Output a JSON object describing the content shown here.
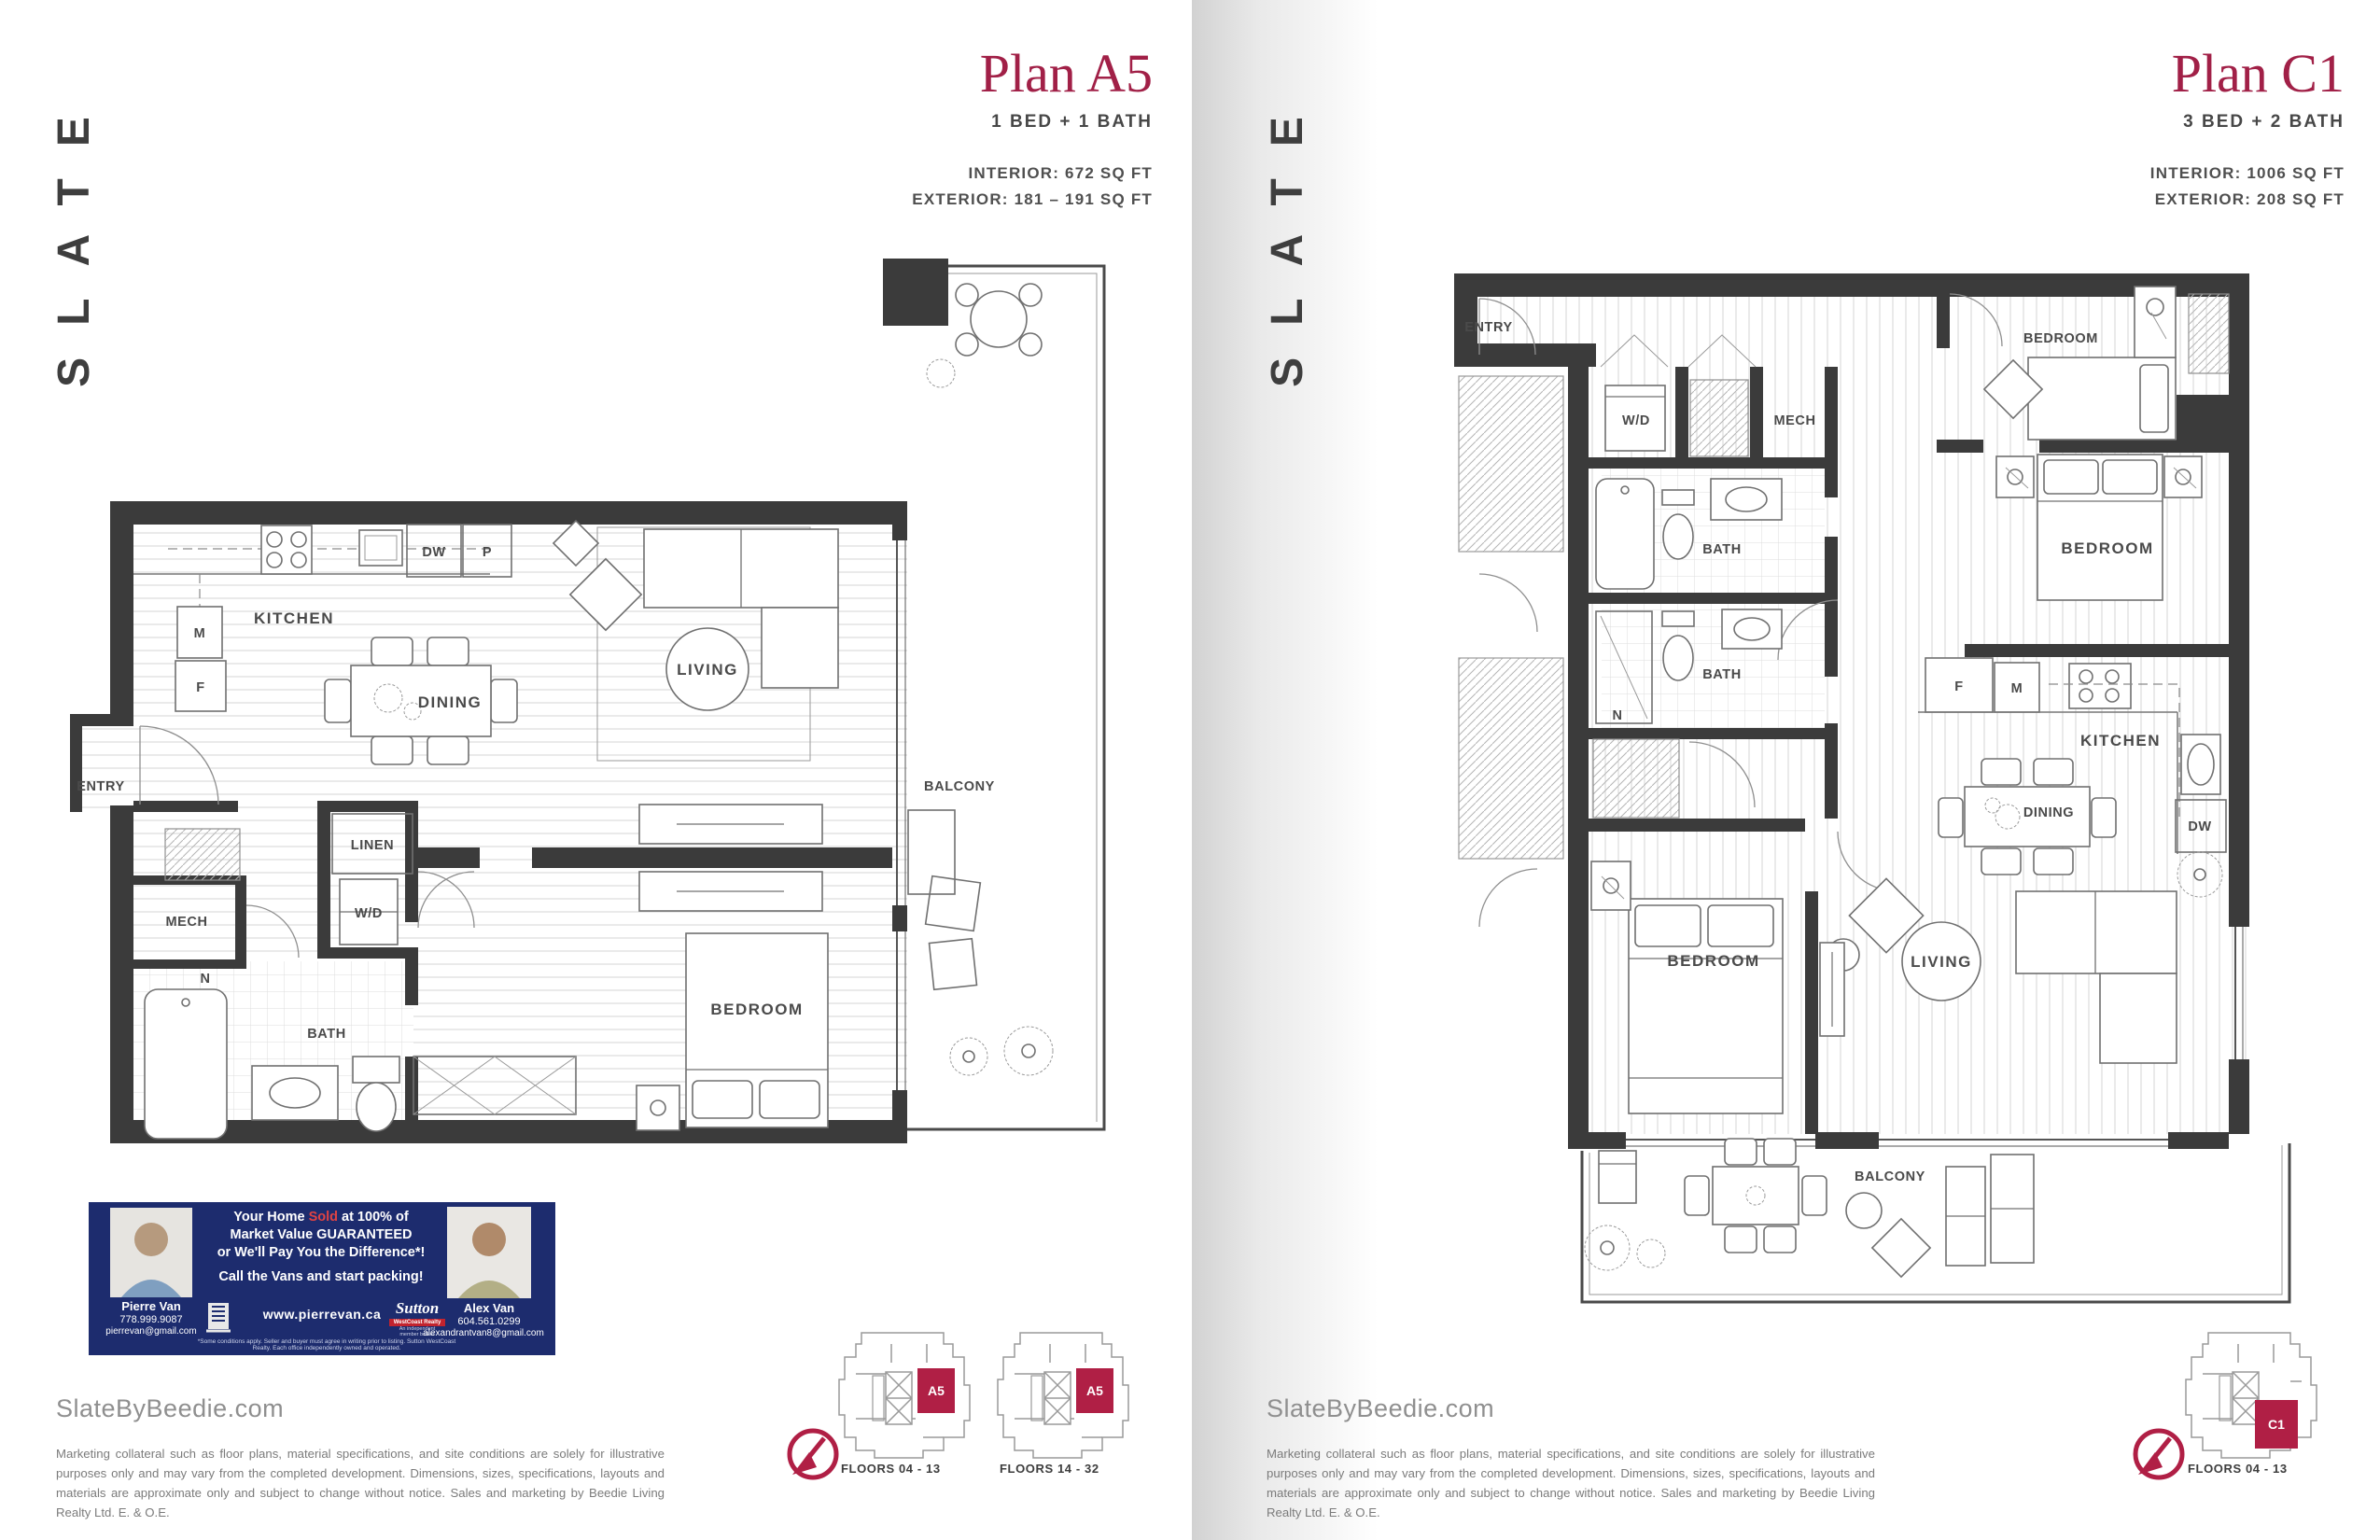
{
  "brand": {
    "logo_vertical": "SLATE",
    "website": "SlateByBeedie.com"
  },
  "disclaimer": "Marketing collateral such as floor plans, material specifications, and site conditions are solely for illustrative purposes only and may vary from the completed development. Dimensions, sizes, specifications, layouts and materials are approximate only and subject to change without notice. Sales and marketing by Beedie Living Realty Ltd. E. & O.E.",
  "plan_a5": {
    "title": "Plan A5",
    "configuration": "1 BED + 1 BATH",
    "interior": "INTERIOR: 672 SQ FT",
    "exterior": "EXTERIOR: 181 – 191 SQ FT",
    "rooms": {
      "kitchen": "KITCHEN",
      "dining": "DINING",
      "living": "LIVING",
      "balcony": "BALCONY",
      "entry": "ENTRY",
      "mech": "MECH",
      "bath": "BATH",
      "bedroom": "BEDROOM",
      "linen": "LINEN",
      "wd": "W/D",
      "dw": "DW",
      "pantry": "P",
      "microwave": "M",
      "fridge": "F",
      "nook": "N"
    },
    "keyplates": [
      {
        "unit": "A5",
        "floors": "FLOORS 04 - 13"
      },
      {
        "unit": "A5",
        "floors": "FLOORS 14 - 32"
      }
    ]
  },
  "plan_c1": {
    "title": "Plan C1",
    "configuration": "3 BED + 2 BATH",
    "interior": "INTERIOR: 1006 SQ FT",
    "exterior": "EXTERIOR: 208 SQ FT",
    "rooms": {
      "entry": "ENTRY",
      "wd": "W/D",
      "mech": "MECH",
      "bath1": "BATH",
      "bath2": "BATH",
      "bedroom1": "BEDROOM",
      "bedroom2": "BEDROOM",
      "bedroom3": "BEDROOM",
      "kitchen": "KITCHEN",
      "dining": "DINING",
      "living": "LIVING",
      "balcony": "BALCONY",
      "dw": "DW",
      "fridge": "F",
      "microwave": "M",
      "nook": "N"
    },
    "keyplates": [
      {
        "unit": "C1",
        "floors": "FLOORS 04 - 13"
      }
    ]
  },
  "ad": {
    "headline_pre": "Your Home ",
    "headline_sold": "Sold",
    "headline_post": " at 100% of",
    "headline_line2": "Market Value GUARANTEED",
    "headline_line3": "or We'll Pay You the Difference*!",
    "cta": "Call the Vans and start packing!",
    "agents": [
      {
        "name": "Pierre Van",
        "phone": "778.999.9087",
        "email": "pierrevan@gmail.com"
      },
      {
        "name": "Alex Van",
        "phone": "604.561.0299",
        "email": "alexandrantvan8@gmail.com"
      }
    ],
    "website": "www.pierrevan.ca",
    "brokerage_name": "Sutton",
    "brokerage_bar": "WestCoast Realty",
    "brokerage_sub": "An independent member broker",
    "fine_print": "*Some conditions apply. Seller and buyer must agree in writing prior to listing. Sutton WestCoast Realty. Each office independently owned and operated."
  }
}
